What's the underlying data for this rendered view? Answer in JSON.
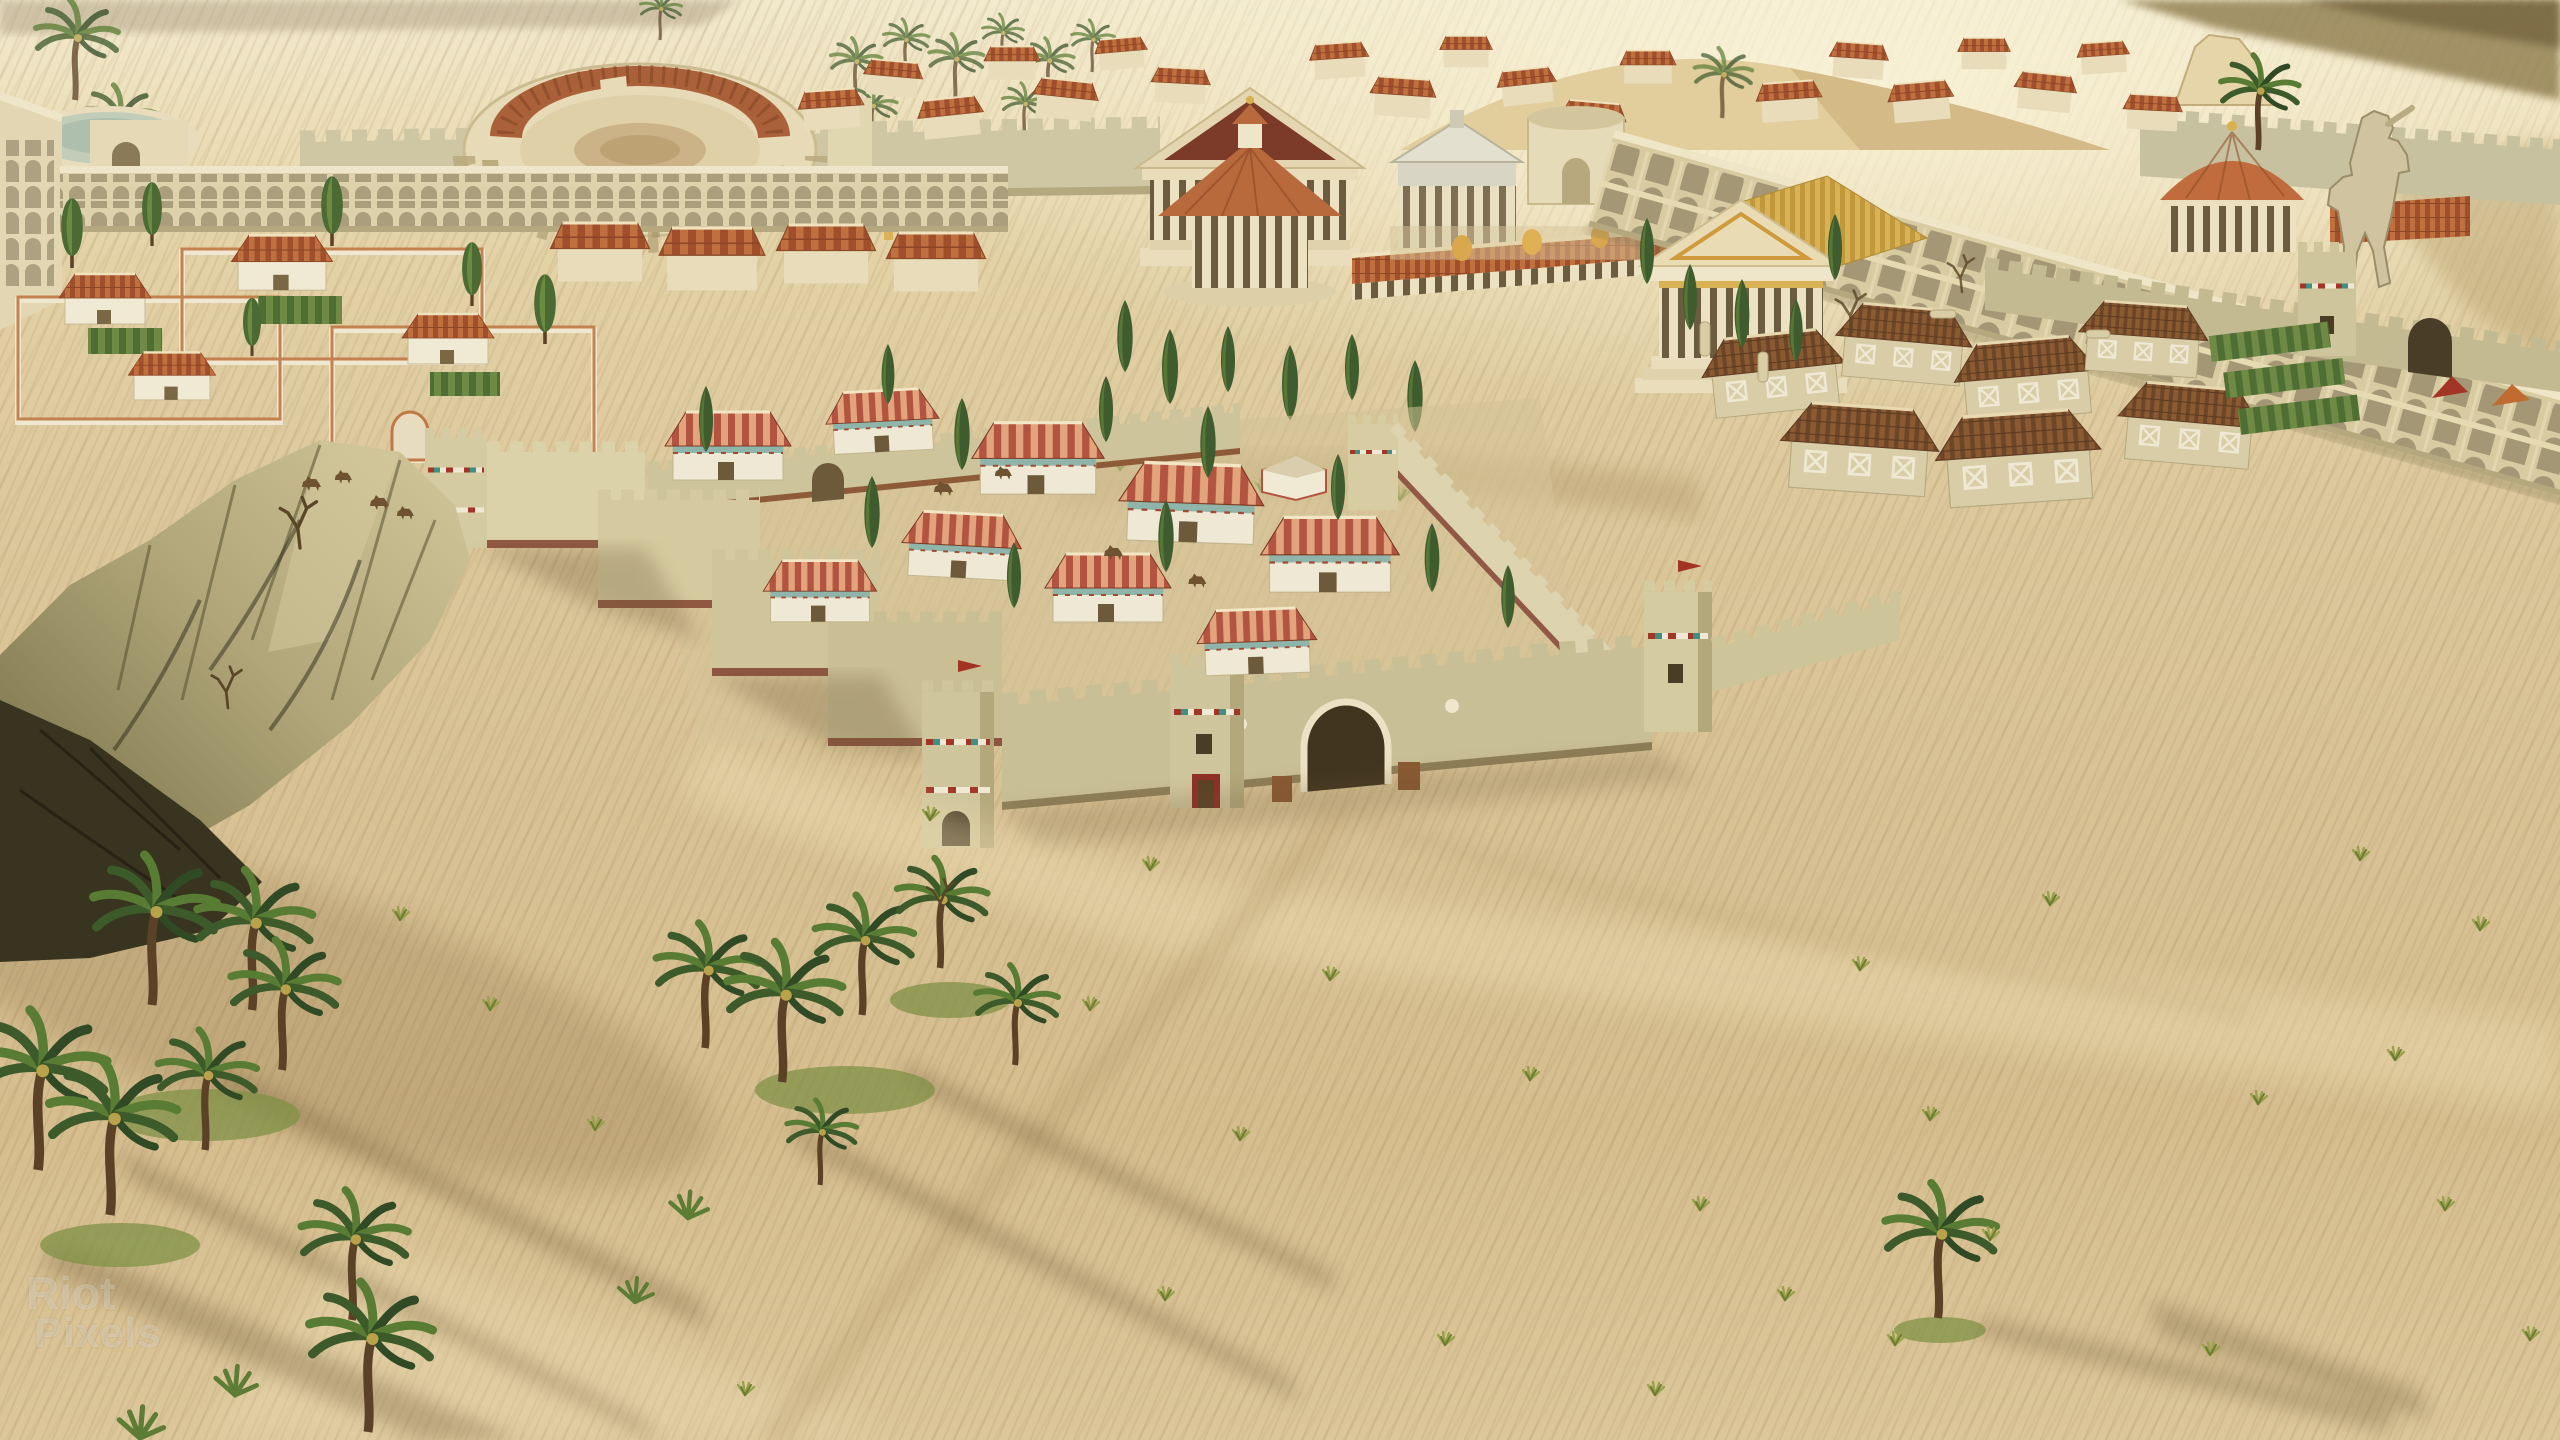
{
  "screenshot": {
    "kind": "game-screenshot",
    "view": "aerial-city-view",
    "hud_visible": false
  },
  "watermark": {
    "line1": "Riot",
    "line2": "Pixels"
  },
  "palette": {
    "sky_haze": "#f4ecd2",
    "sand_light": "#e9dab2",
    "sand_base": "#d8c496",
    "sand_deep": "#cdb584",
    "sand_shadow": "#6b5433",
    "stone_cream": "#e9ddba",
    "stone_white": "#f1ead6",
    "wall_sage": "#cdc5a0",
    "wall_shade": "#b2a77d",
    "wall_base_stripe": "#7e3b2a",
    "roof_terracotta": "#c0703f",
    "roof_terracotta_deep": "#a04f2c",
    "roof_brown": "#8a5a33",
    "roof_gold": "#d9b255",
    "trim_red": "#a33526",
    "trim_teal": "#3f8f82",
    "tree_dark_green": "#3c5a2a",
    "tree_mid_green": "#587c33",
    "grass_green": "#7f9146",
    "mountain_lit": "#cbbf94",
    "mountain_dark": "#3a3520",
    "statue_bronze": "#cfc3a0",
    "watermark_color": "rgba(255,255,255,0.28)"
  },
  "scene": {
    "landmarks": [
      "amphitheater",
      "circular-pool",
      "two-story-colonnade",
      "city-wall",
      "round-temple",
      "great-temple",
      "drum-monument",
      "grey-temple",
      "lion-courtyard",
      "gold-roof-temple",
      "aqueduct-arcade",
      "colossus-statue",
      "domed-tholos",
      "warehouse-district",
      "villa-district",
      "fortress",
      "fortress-gate",
      "mountain",
      "palm-oasis",
      "desert-sand"
    ]
  }
}
